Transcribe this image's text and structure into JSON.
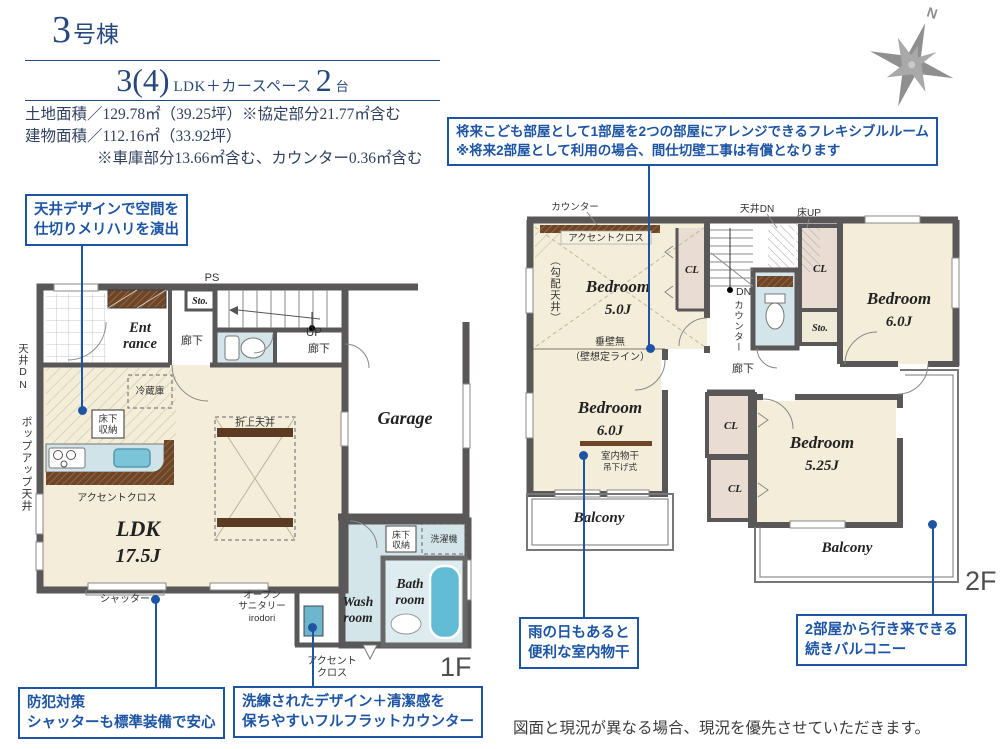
{
  "header": {
    "unit_number": "3",
    "unit_suffix": "号棟",
    "plan_count": "3(4)",
    "plan_type": "LDK＋カースペース",
    "car_count": "2",
    "car_suffix": "台",
    "land_area": "土地面積／129.78㎡（39.25坪）※協定部分21.77㎡含む",
    "building_area": "建物面積／112.16㎡（33.92坪）",
    "building_note": "※車庫部分13.66㎡含む、カウンター0.36㎡含む"
  },
  "compass": {
    "label": "N"
  },
  "callouts": {
    "flexible_room": {
      "line1": "将来こども部屋として1部屋を2つの部屋にアレンジできるフレキシブルルーム",
      "line2": "※将来2部屋として利用の場合、間仕切壁工事は有償となります"
    },
    "ceiling_design": {
      "line1": "天井デザインで空間を",
      "line2": "仕切りメリハリを演出"
    },
    "security_shutter": {
      "line1": "防犯対策",
      "line2": "シャッターも標準装備で安心"
    },
    "flat_counter": {
      "line1": "洗練されたデザイン＋清潔感を",
      "line2": "保ちやすいフルフラットカウンター"
    },
    "indoor_drying": {
      "line1": "雨の日もあると",
      "line2": "便利な室内物干"
    },
    "continuous_balcony": {
      "line1": "2部屋から行き来できる",
      "line2": "続きバルコニー"
    }
  },
  "floor1": {
    "label": "1F",
    "ldk": {
      "name": "LDK",
      "size": "17.5J"
    },
    "entrance": {
      "line1": "Ent",
      "line2": "rance"
    },
    "garage": "Garage",
    "washroom": {
      "line1": "Wash",
      "line2": "room"
    },
    "bathroom": {
      "line1": "Bath",
      "line2": "room"
    },
    "hall1": "廊下",
    "up": "UP",
    "hall2": "廊下",
    "ps": "PS",
    "sto": "Sto.",
    "ceiling_dn": "天井DN",
    "popup_ceiling": "ポップアップ天井",
    "fridge": "冷蔵庫",
    "underfloor_storage": {
      "line1": "床下",
      "line2": "収納"
    },
    "underfloor_storage2": {
      "line1": "床下",
      "line2": "収納"
    },
    "accent_cross": "アクセントクロス",
    "accent_cross2": {
      "line1": "アクセント",
      "line2": "クロス"
    },
    "folded_ceiling": "折上天井",
    "shutter": "シャッター",
    "open_sanitary": {
      "line1": "オープン",
      "line2": "サニタリー",
      "line3": "irodori"
    },
    "laundry": "洗濯機"
  },
  "floor2": {
    "label": "2F",
    "bedroom1": {
      "name": "Bedroom",
      "size": "5.0J"
    },
    "bedroom2": {
      "name": "Bedroom",
      "size": "6.0J"
    },
    "bedroom3": {
      "name": "Bedroom",
      "size": "6.0J"
    },
    "bedroom4": {
      "name": "Bedroom",
      "size": "5.25J"
    },
    "balcony1": "Balcony",
    "balcony2": "Balcony",
    "cl1": "CL",
    "cl2": "CL",
    "cl3": "CL",
    "cl4": "CL",
    "sto": "Sto.",
    "hall": "廊下",
    "counter_top": "カウンター",
    "accent_cross": "アクセントクロス",
    "sloped_ceiling": "（勾配天井）",
    "ceiling_dn": "天井DN",
    "floor_up": "床UP",
    "dn": "DN",
    "counter_side": "カウンター",
    "hanging_wall": {
      "line1": "垂壁無",
      "line2": "（壁想定ライン）"
    },
    "indoor_pole": "室内物干",
    "hanging_type": "吊下げ式"
  },
  "footer": {
    "disclaimer": "図面と現況が異なる場合、現況を優先させていただきます。"
  },
  "colors": {
    "accent_blue": "#1d55a4",
    "wall_gray": "#595757",
    "room_cream": "#f3edda",
    "water_blue": "#d3e5e8",
    "tub_blue": "#63bcd6",
    "closet_beige": "#e9dcd2",
    "wood_brown": "#6e4527",
    "title_navy": "#26497d"
  }
}
